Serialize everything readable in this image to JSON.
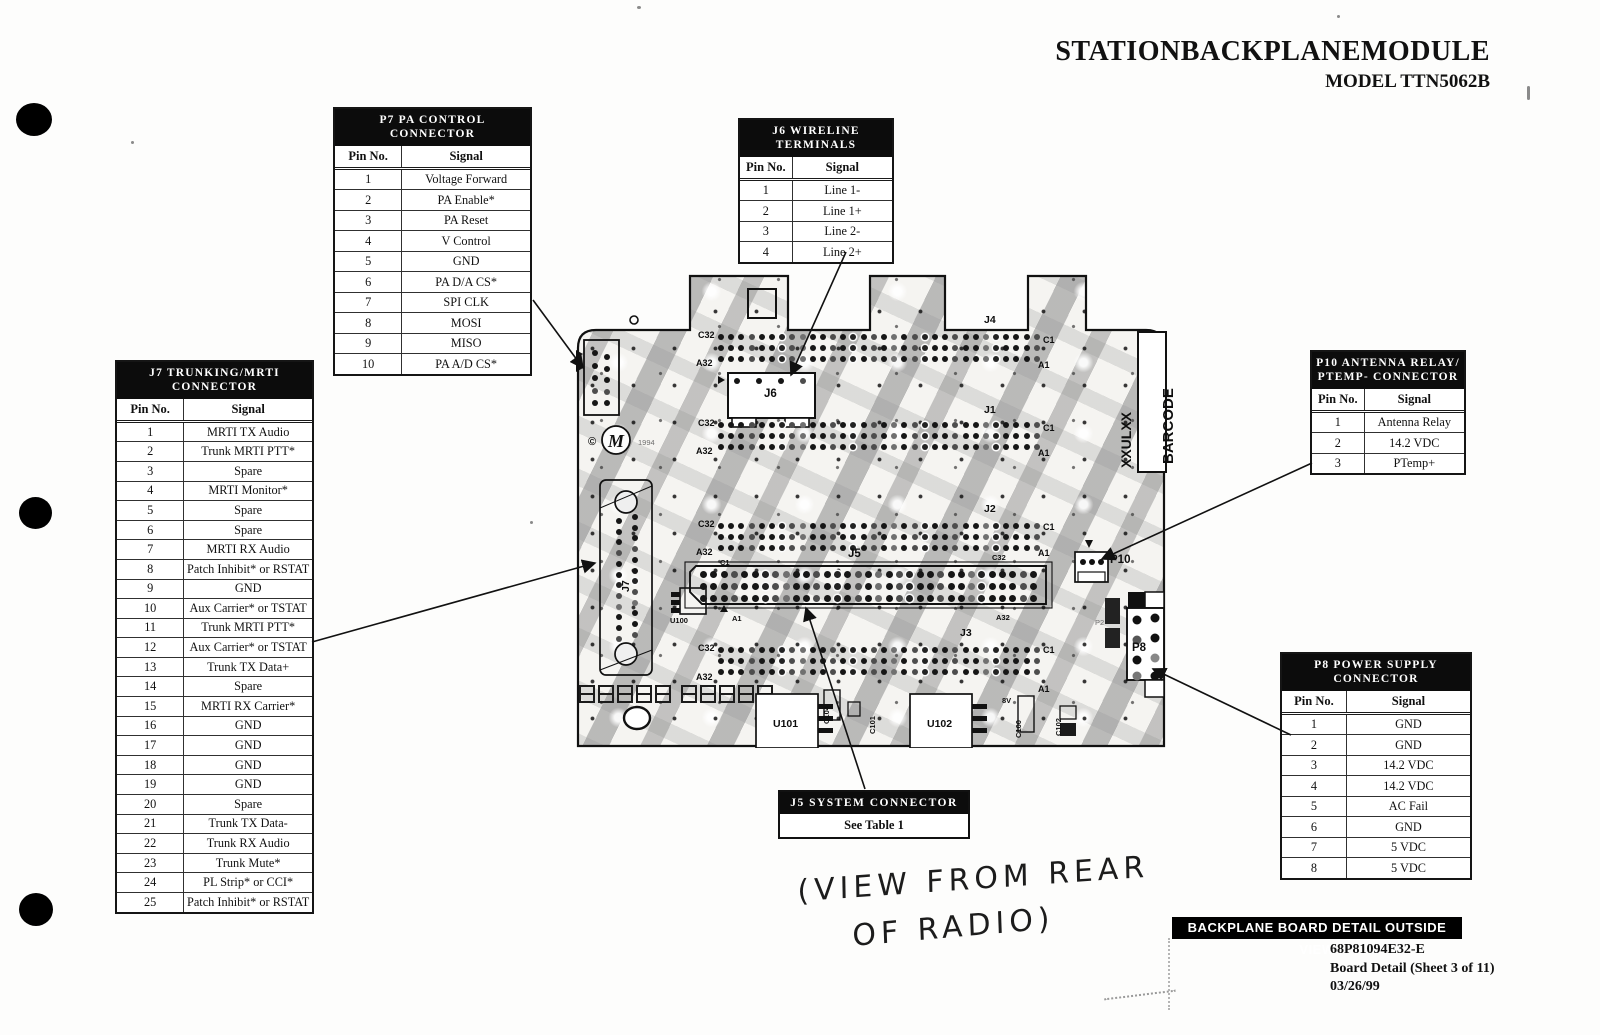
{
  "page": {
    "title": "STATIONBACKPLANEMODULE",
    "model": "MODEL TTN5062B",
    "footer_bar": "BACKPLANE BOARD DETAIL OUTSIDE VIEW",
    "footer_lines": [
      "68P81094E32-E",
      "Board Detail (Sheet 3 of 11)",
      "03/26/99"
    ],
    "handwritten_line1": "(VIEW FROM REAR",
    "handwritten_line2": "OF RADIO)"
  },
  "tables": {
    "p7": {
      "title": "P7  PA CONTROL CONNECTOR",
      "col_pin": "Pin No.",
      "col_signal": "Signal",
      "rows": [
        [
          "1",
          "Voltage Forward"
        ],
        [
          "2",
          "PA Enable*"
        ],
        [
          "3",
          "PA Reset"
        ],
        [
          "4",
          "V Control"
        ],
        [
          "5",
          "GND"
        ],
        [
          "6",
          "PA D/A CS*"
        ],
        [
          "7",
          "SPI CLK"
        ],
        [
          "8",
          "MOSI"
        ],
        [
          "9",
          "MISO"
        ],
        [
          "10",
          "PA A/D CS*"
        ]
      ]
    },
    "j6": {
      "title": "J6  WIRELINE TERMINALS",
      "col_pin": "Pin No.",
      "col_signal": "Signal",
      "rows": [
        [
          "1",
          "Line 1-"
        ],
        [
          "2",
          "Line 1+"
        ],
        [
          "3",
          "Line 2-"
        ],
        [
          "4",
          "Line 2+"
        ]
      ]
    },
    "j7": {
      "title": "J7  TRUNKING/MRTI CONNECTOR",
      "col_pin": "Pin No.",
      "col_signal": "Signal",
      "rows": [
        [
          "1",
          "MRTI TX Audio"
        ],
        [
          "2",
          "Trunk MRTI PTT*"
        ],
        [
          "3",
          "Spare"
        ],
        [
          "4",
          "MRTI Monitor*"
        ],
        [
          "5",
          "Spare"
        ],
        [
          "6",
          "Spare"
        ],
        [
          "7",
          "MRTI RX Audio"
        ],
        [
          "8",
          "Patch Inhibit* or RSTAT"
        ],
        [
          "9",
          "GND"
        ],
        [
          "10",
          "Aux Carrier* or TSTAT"
        ],
        [
          "11",
          "Trunk MRTI PTT*"
        ],
        [
          "12",
          "Aux Carrier* or TSTAT"
        ],
        [
          "13",
          "Trunk TX Data+"
        ],
        [
          "14",
          "Spare"
        ],
        [
          "15",
          "MRTI RX Carrier*"
        ],
        [
          "16",
          "GND"
        ],
        [
          "17",
          "GND"
        ],
        [
          "18",
          "GND"
        ],
        [
          "19",
          "GND"
        ],
        [
          "20",
          "Spare"
        ],
        [
          "21",
          "Trunk TX Data-"
        ],
        [
          "22",
          "Trunk RX Audio"
        ],
        [
          "23",
          "Trunk Mute*"
        ],
        [
          "24",
          "PL Strip* or CCI*"
        ],
        [
          "25",
          "Patch Inhibit* or RSTAT"
        ]
      ]
    },
    "p10": {
      "title_line1": "P10  ANTENNA RELAY/",
      "title_line2": "PTEMP- CONNECTOR",
      "col_pin": "Pin No.",
      "col_signal": "Signal",
      "rows": [
        [
          "1",
          "Antenna Relay"
        ],
        [
          "2",
          "14.2 VDC"
        ],
        [
          "3",
          "PTemp+"
        ]
      ]
    },
    "p8": {
      "title": "P8  POWER SUPPLY CONNECTOR",
      "col_pin": "Pin No.",
      "col_signal": "Signal",
      "rows": [
        [
          "1",
          "GND"
        ],
        [
          "2",
          "GND"
        ],
        [
          "3",
          "14.2 VDC"
        ],
        [
          "4",
          "14.2 VDC"
        ],
        [
          "5",
          "AC Fail"
        ],
        [
          "6",
          "GND"
        ],
        [
          "7",
          "5 VDC"
        ],
        [
          "8",
          "5 VDC"
        ]
      ]
    },
    "j5label": {
      "title": "J5  SYSTEM CONNECTOR",
      "body": "See Table 1"
    }
  },
  "board": {
    "labels": {
      "j1": "J1",
      "j2": "J2",
      "j3": "J3",
      "j4": "J4",
      "j5": "J5",
      "j6": "J6",
      "j7": "J7",
      "c32": "C32",
      "a32": "A32",
      "c1": "C1",
      "a1": "A1",
      "p2": "P2",
      "p8": "P8",
      "p10": "P10",
      "u100": "U100",
      "u101": "U101",
      "u102": "U102",
      "c100": "C100",
      "c101": "C101",
      "c102": "C102",
      "c104": "C104",
      "v8": "8V",
      "barcode": "BARCODE",
      "xxulxx": "XXULXX",
      "copyright": "©",
      "year": "1994",
      "m": "M"
    }
  }
}
